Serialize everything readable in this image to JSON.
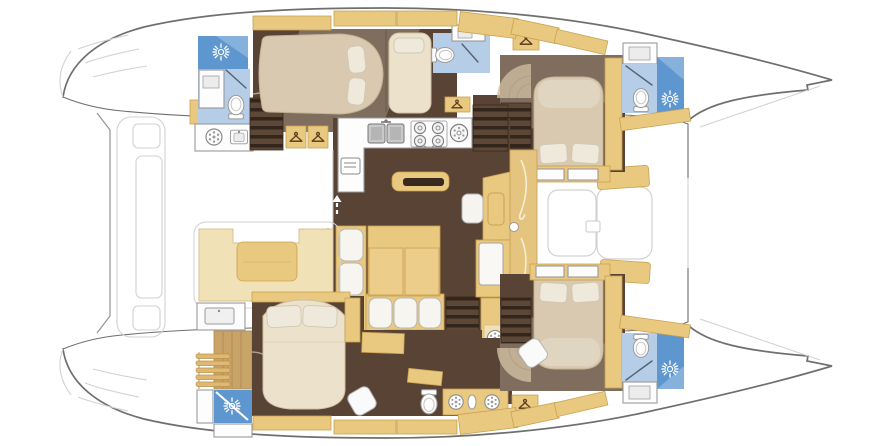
{
  "document": {
    "label": "catamaran-yacht-interior-floor-plan"
  },
  "palette": {
    "bg": "#ffffff",
    "hull-line": "#6f6f6f",
    "faint-line": "#d2d2d2",
    "tan": "#e9c87f",
    "tan-light": "#f1e1b6",
    "tan-dark": "#c9a253",
    "cream-bed": "#d8c9b0",
    "bed-white": "#ece2cc",
    "pillow": "#efe9dc",
    "floor-brown": "#594334",
    "stair-dark": "#32251b",
    "stair-mid": "#5d4736",
    "wood": "#c9a469",
    "blue-floor": "#b5cde7",
    "blue-shower": "#5e97d0",
    "fixture-white": "#fdfdfd",
    "fixture-line": "#9a9a9a"
  },
  "regions": [
    {
      "name": "aft-cockpit"
    },
    {
      "name": "salon"
    },
    {
      "name": "galley"
    },
    {
      "name": "nav-station"
    },
    {
      "name": "port-aft-cabin"
    },
    {
      "name": "port-forward-cabin"
    },
    {
      "name": "starboard-aft-cabin"
    },
    {
      "name": "starboard-forward-cabin"
    },
    {
      "name": "port-aft-head"
    },
    {
      "name": "port-forward-head"
    },
    {
      "name": "starboard-aft-head"
    },
    {
      "name": "starboard-forward-head"
    },
    {
      "name": "forward-cockpit"
    },
    {
      "name": "aft-platform"
    }
  ],
  "icons": {
    "shower": "sun-spray-icon",
    "wardrobe": "clothes-hanger-icon",
    "washing_machine": "porthole-drum-icon",
    "toilet": "wc-icon",
    "sink": "basin-icon",
    "stove": "four-burner-icon",
    "round_hob": "single-burner-icon",
    "companionway": "up-arrow-icon"
  }
}
